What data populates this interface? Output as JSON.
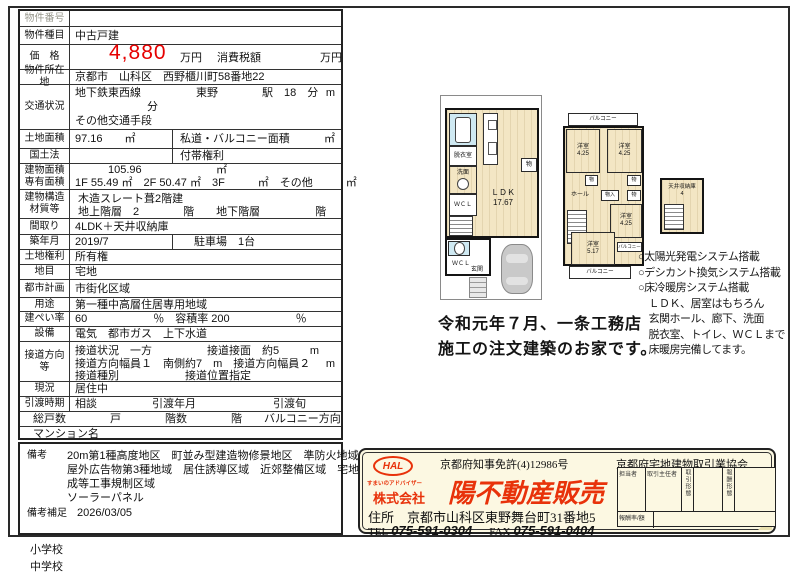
{
  "units": {
    "m": "m",
    "sqm": "㎡"
  },
  "table": {
    "no": {
      "label": "物件番号",
      "value": ""
    },
    "type": {
      "label": "物件種目",
      "value": "中古戸建"
    },
    "price": {
      "label": "価　格",
      "amount": "4,880",
      "unit": "万円",
      "tax_label": "消費税額",
      "tax_unit": "万円"
    },
    "loc": {
      "label": "物件所在地",
      "value": "京都市　山科区　西野櫃川町58番地22"
    },
    "trans": {
      "label": "交通状況",
      "l1": "地下鉄東西線　　　　　東野　　　　駅　18　分",
      "l2": "分",
      "l3": "その他交通手段"
    },
    "land": {
      "label": "土地面積",
      "v1": "97.16　　㎡",
      "v2": "私道・バルコニー面積"
    },
    "kokudo": {
      "label": "国土法",
      "v2": "付帯権利"
    },
    "barea": {
      "label1": "建物面積",
      "label2": "専有面積",
      "v1": "105.96",
      "v1u": "㎡",
      "v2": "1F 55.49 ㎡　2F 50.47 ㎡　3F　　　㎡　その他　　　㎡"
    },
    "struct": {
      "label1": "建物構造",
      "label2": "材質等",
      "v1": "木造スレート葺2階建",
      "v2": "地上階層　2　　　　階　　地下階層　　　　　階"
    },
    "madori": {
      "label": "間取り",
      "value": "4LDK＋天井収納庫"
    },
    "chiku": {
      "label": "築年月",
      "v1": "2019/7",
      "v2": "駐車場　1台"
    },
    "kenri": {
      "label": "土地権利",
      "value": "所有権"
    },
    "chimoku": {
      "label": "地目",
      "value": "宅地"
    },
    "toshi": {
      "label": "都市計画",
      "value": "市街化区域"
    },
    "yoto": {
      "label": "用途",
      "value": "第一種中高層住居専用地域"
    },
    "kenpei": {
      "label": "建ぺい率",
      "value": "60　　　　　　％　容積率 200　　　　　　％"
    },
    "setsubi": {
      "label": "設備",
      "value": "電気　都市ガス　上下水道"
    },
    "setsudo": {
      "label": "接道方向等",
      "l1": "接道状況　一方　　　　　接道接面　約5",
      "l2": "接道方向幅員１　南側約7　m　接道方向幅員２",
      "l3": "接道種別　　　　　　接道位置指定"
    },
    "genkyo": {
      "label": "現況",
      "value": "居住中"
    },
    "hikiwatashi": {
      "label": "引渡時期",
      "value": "相談　　　　　引渡年月　　　　　　　引渡旬"
    },
    "kosu": {
      "value": "総戸数　　　　戸　　　　階数　　　　階　　バルコニー方向"
    },
    "mansion": {
      "value": "マンション名"
    }
  },
  "remarks": {
    "label": "備考",
    "lines": [
      "20m第1種高度地区　町並み型建造物修景地区　準防火地域",
      "屋外広告物第3種地域　居住誘導区域　近郊整備区域　宅地造",
      "成等工事規制区域",
      "ソーラーパネル"
    ],
    "label2": "備考補足",
    "value2": "2026/03/05"
  },
  "schools": {
    "elementary": "小学校",
    "junior": "中学校"
  },
  "floorplan": {
    "f1": {
      "datsui": "脱衣室",
      "senmen": "洗面",
      "wcl1": "ＷＣＬ",
      "mono": "物",
      "ldk": "ＬＤＫ",
      "ldk_size": "17.67",
      "wcl2": "ＷＣＬ",
      "genkan": "玄関"
    },
    "f2": {
      "balcony_top": "バルコニー",
      "y1": "洋室",
      "y1s": "4.25",
      "y2": "洋室",
      "y2s": "4.25",
      "mono_a": "物",
      "monoiri": "物入",
      "mono_b": "物",
      "mono_c": "物",
      "hall": "ホール",
      "y3": "洋室",
      "y3s": "4.25",
      "y4": "洋室",
      "y4s": "5.17",
      "balcony_small": "バルコニー",
      "balcony_bottom": "バルコニー"
    },
    "attic": {
      "label": "天井収納庫",
      "size": "4"
    },
    "caption1": "令和元年７月、一条工務店",
    "caption2": "施工の注文建築のお家です。",
    "features": [
      "○太陽光発電システム搭載",
      "○デシカント換気システム搭載",
      "○床冷暖房システム搭載",
      "　ＬＤＫ、居室はもちろん",
      "　玄関ホール、廊下、洗面",
      "　脱衣室、トイレ、ＷＣＬまで",
      "　床暖房完備してます。"
    ]
  },
  "company": {
    "license": "京都府知事免許(4)12986号",
    "association": "京都府宅地建物取引業協会",
    "logo_text": "HAL",
    "logo_sub": "すまいのアドバイザー",
    "kabushiki": "株式会社",
    "name": "陽不動産販売",
    "address_label": "住所",
    "address": "京都市山科区東野舞台町31番地5",
    "tel_label": "TEL",
    "tel": "075-591-0304",
    "fax_label": "FAX",
    "fax": "075-591-0404",
    "staff": {
      "c1": "担当者",
      "c2": "取引主任者",
      "c3": "取引形態",
      "c4": "報酬形態",
      "row2": "報酬率/額"
    }
  },
  "colors": {
    "accent_red": "#e60000",
    "company_red": "#e8320a",
    "floor_cream": "#f3e6c4",
    "bath_blue": "#cfe9f2"
  }
}
